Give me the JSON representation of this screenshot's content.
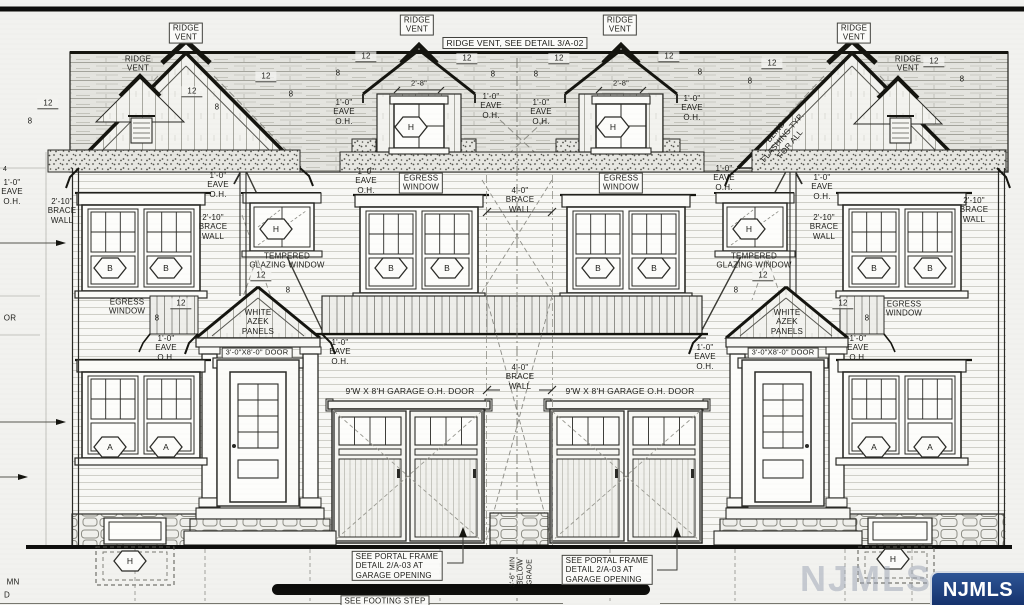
{
  "watermark": {
    "badge_text": "NJMLS",
    "ghost_text": "NJMLS",
    "badge_bg": "#14306a",
    "badge_fg": "#ffffff"
  },
  "labels": [
    {
      "name": "ridge-vent-label-1",
      "text": "RIDGE\nVENT",
      "x": 186,
      "y": 33,
      "boxed": true
    },
    {
      "name": "ridge-vent-label-2",
      "text": "RIDGE\nVENT",
      "x": 138,
      "y": 64
    },
    {
      "name": "ridge-vent-label-3",
      "text": "RIDGE\nVENT",
      "x": 417,
      "y": 25,
      "boxed": true
    },
    {
      "name": "ridge-vent-detail-note",
      "text": "RIDGE VENT, SEE DETAIL 3/A-02",
      "x": 515,
      "y": 43,
      "boxed": true,
      "size": 8.5
    },
    {
      "name": "ridge-vent-label-4",
      "text": "RIDGE\nVENT",
      "x": 620,
      "y": 25,
      "boxed": true
    },
    {
      "name": "ridge-vent-label-5",
      "text": "RIDGE\nVENT",
      "x": 854,
      "y": 33,
      "boxed": true
    },
    {
      "name": "ridge-vent-label-6",
      "text": "RIDGE\nVENT",
      "x": 908,
      "y": 64
    },
    {
      "name": "blind-flashing-note",
      "text": "BLIND\nFLASHING TYP.\nFOR ALL",
      "x": 783,
      "y": 138,
      "rot": -50
    },
    {
      "name": "eave-oh-label-1",
      "text": "1'-0\"\nEAVE\nO.H.",
      "x": 12,
      "y": 192
    },
    {
      "name": "eave-oh-label-2",
      "text": "1'-0\"\nEAVE\nO.H.",
      "x": 218,
      "y": 185
    },
    {
      "name": "eave-oh-label-3",
      "text": "1'-0\"\nEAVE\nO.H.",
      "x": 344,
      "y": 112
    },
    {
      "name": "eave-oh-label-4",
      "text": "1'-0\"\nEAVE\nO.H.",
      "x": 491,
      "y": 106
    },
    {
      "name": "eave-oh-label-5",
      "text": "1'-0\"\nEAVE\nO.H.",
      "x": 541,
      "y": 112
    },
    {
      "name": "eave-oh-label-6",
      "text": "1'-0\"\nEAVE\nO.H.",
      "x": 692,
      "y": 108
    },
    {
      "name": "eave-oh-label-7",
      "text": "1'-0\"\nEAVE\nO.H.",
      "x": 822,
      "y": 187
    },
    {
      "name": "eave-oh-label-8",
      "text": "1'-0\"\nEAVE\nO.H.",
      "x": 366,
      "y": 181
    },
    {
      "name": "eave-oh-label-9",
      "text": "1'-0\"\nEAVE\nO.H.",
      "x": 724,
      "y": 178
    },
    {
      "name": "eave-oh-label-10",
      "text": "1'-0\"\nEAVE\nO.H.",
      "x": 340,
      "y": 352
    },
    {
      "name": "eave-oh-label-11",
      "text": "1'-0\"\nEAVE\nO.H.",
      "x": 705,
      "y": 357
    },
    {
      "name": "eave-oh-label-12",
      "text": "1'-0\"\nEAVE\nO.H.",
      "x": 166,
      "y": 348
    },
    {
      "name": "eave-oh-label-13",
      "text": "1'-0\"\nEAVE\nO.H.",
      "x": 858,
      "y": 348
    },
    {
      "name": "brace-wall-label-left",
      "text": "2'-10\"\nBRACE\nWALL",
      "x": 62,
      "y": 211
    },
    {
      "name": "brace-wall-label-left-inner",
      "text": "2'-10\"\nBRACE\nWALL",
      "x": 213,
      "y": 227
    },
    {
      "name": "brace-wall-label-right-inner",
      "text": "2'-10\"\nBRACE\nWALL",
      "x": 824,
      "y": 227
    },
    {
      "name": "brace-wall-label-right",
      "text": "2'-10\"\nBRACE\nWALL",
      "x": 974,
      "y": 210
    },
    {
      "name": "brace-wall-label-center-upper",
      "text": "4'-0\"\nBRACE\nWALL",
      "x": 520,
      "y": 200
    },
    {
      "name": "brace-wall-label-center-lower",
      "text": "4'-0\"\nBRACE\nWALL",
      "x": 520,
      "y": 377
    },
    {
      "name": "egress-window-label-left",
      "text": "EGRESS\nWINDOW",
      "x": 127,
      "y": 307
    },
    {
      "name": "egress-window-label-center-left",
      "text": "EGRESS\nWINDOW",
      "x": 421,
      "y": 183,
      "boxed": true
    },
    {
      "name": "egress-window-label-center-right",
      "text": "EGRESS\nWINDOW",
      "x": 621,
      "y": 183,
      "boxed": true
    },
    {
      "name": "egress-window-label-right",
      "text": "EGRESS\nWINDOW",
      "x": 904,
      "y": 309
    },
    {
      "name": "tempered-glazing-label-left",
      "text": "TEMPERED\nGLAZING WINDOW",
      "x": 287,
      "y": 261
    },
    {
      "name": "tempered-glazing-label-right",
      "text": "TEMPERED\nGLAZING WINDOW",
      "x": 754,
      "y": 261
    },
    {
      "name": "azek-panels-label-left",
      "text": "WHITE\nAZEK\nPANELS",
      "x": 258,
      "y": 322
    },
    {
      "name": "azek-panels-label-right",
      "text": "WHITE\nAZEK\nPANELS",
      "x": 787,
      "y": 322
    },
    {
      "name": "entry-door-label-left",
      "text": "3'-0\"X8'-0\" DOOR",
      "x": 257,
      "y": 353,
      "boxed": true,
      "size": 7.5
    },
    {
      "name": "entry-door-label-right",
      "text": "3'-0\"X8'-0\" DOOR",
      "x": 783,
      "y": 353,
      "boxed": true,
      "size": 7.5
    },
    {
      "name": "garage-door-label-left",
      "text": "9'W X 8'H GARAGE O.H. DOOR",
      "x": 410,
      "y": 391,
      "size": 8.5
    },
    {
      "name": "garage-door-label-right",
      "text": "9'W X 8'H GARAGE O.H. DOOR",
      "x": 630,
      "y": 391,
      "size": 8.5
    },
    {
      "name": "portal-frame-note-left",
      "text": "SEE PORTAL FRAME\nDETAIL 2/A-03 AT\nGARAGE OPENING",
      "x": 397,
      "y": 566,
      "boxed": true,
      "align": "left"
    },
    {
      "name": "portal-frame-note-right",
      "text": "SEE PORTAL FRAME\nDETAIL 2/A-03 AT\nGARAGE OPENING",
      "x": 607,
      "y": 570,
      "boxed": true,
      "align": "left"
    },
    {
      "name": "footing-step-note",
      "text": "SEE FOOTING STEP",
      "x": 385,
      "y": 601,
      "boxed": true
    },
    {
      "name": "below-grade-note",
      "text": "3'-6\" MIN\nBELOW\nGRADE",
      "x": 522,
      "y": 572,
      "rot": -90,
      "size": 7
    },
    {
      "name": "dormer-width-dim-left",
      "text": "2'-8\"",
      "x": 419,
      "y": 84,
      "size": 7.5
    },
    {
      "name": "dormer-width-dim-right",
      "text": "2'-8\"",
      "x": 621,
      "y": 84,
      "size": 7.5
    },
    {
      "name": "partial-text-door",
      "text": "OR",
      "x": 10,
      "y": 318
    },
    {
      "name": "partial-text-column",
      "text": "MN",
      "x": 13,
      "y": 582
    },
    {
      "name": "partial-text-beyond",
      "text": "D",
      "x": 7,
      "y": 595
    },
    {
      "name": "partial-text-4",
      "text": "4",
      "x": 5,
      "y": 170,
      "size": 7
    },
    {
      "name": "slope-12-1",
      "text": "12",
      "x": 48,
      "y": 104,
      "cls": "dim"
    },
    {
      "name": "slope-12-2",
      "text": "12",
      "x": 192,
      "y": 92,
      "cls": "dim"
    },
    {
      "name": "slope-12-3",
      "text": "12",
      "x": 266,
      "y": 77,
      "cls": "dim"
    },
    {
      "name": "slope-12-4",
      "text": "12",
      "x": 366,
      "y": 57,
      "cls": "dim"
    },
    {
      "name": "slope-12-5",
      "text": "12",
      "x": 467,
      "y": 59,
      "cls": "dim"
    },
    {
      "name": "slope-12-6",
      "text": "12",
      "x": 559,
      "y": 59,
      "cls": "dim"
    },
    {
      "name": "slope-12-7",
      "text": "12",
      "x": 669,
      "y": 57,
      "cls": "dim"
    },
    {
      "name": "slope-12-8",
      "text": "12",
      "x": 772,
      "y": 64,
      "cls": "dim"
    },
    {
      "name": "slope-12-9",
      "text": "12",
      "x": 934,
      "y": 62,
      "cls": "dim"
    },
    {
      "name": "slope-12-10",
      "text": "12",
      "x": 261,
      "y": 276,
      "cls": "dim"
    },
    {
      "name": "slope-12-11",
      "text": "12",
      "x": 763,
      "y": 276,
      "cls": "dim"
    },
    {
      "name": "slope-12-12",
      "text": "12",
      "x": 181,
      "y": 304,
      "cls": "dim"
    },
    {
      "name": "slope-12-13",
      "text": "12",
      "x": 843,
      "y": 304,
      "cls": "dim"
    },
    {
      "name": "slope-8-1",
      "text": "8",
      "x": 30,
      "y": 121
    },
    {
      "name": "slope-8-2",
      "text": "8",
      "x": 217,
      "y": 107
    },
    {
      "name": "slope-8-3",
      "text": "8",
      "x": 291,
      "y": 94
    },
    {
      "name": "slope-8-4",
      "text": "8",
      "x": 338,
      "y": 73
    },
    {
      "name": "slope-8-5",
      "text": "8",
      "x": 493,
      "y": 74
    },
    {
      "name": "slope-8-6",
      "text": "8",
      "x": 536,
      "y": 74
    },
    {
      "name": "slope-8-7",
      "text": "8",
      "x": 700,
      "y": 72
    },
    {
      "name": "slope-8-8",
      "text": "8",
      "x": 750,
      "y": 81
    },
    {
      "name": "slope-8-9",
      "text": "8",
      "x": 962,
      "y": 79
    },
    {
      "name": "slope-8-10",
      "text": "8",
      "x": 288,
      "y": 290
    },
    {
      "name": "slope-8-11",
      "text": "8",
      "x": 736,
      "y": 290
    },
    {
      "name": "slope-8-12",
      "text": "8",
      "x": 157,
      "y": 318
    },
    {
      "name": "slope-8-13",
      "text": "8",
      "x": 867,
      "y": 318
    }
  ],
  "hexagons": [
    {
      "letter": "B",
      "x": 110,
      "y": 268
    },
    {
      "letter": "B",
      "x": 166,
      "y": 268
    },
    {
      "letter": "B",
      "x": 391,
      "y": 268
    },
    {
      "letter": "B",
      "x": 447,
      "y": 268
    },
    {
      "letter": "B",
      "x": 598,
      "y": 268
    },
    {
      "letter": "B",
      "x": 654,
      "y": 268
    },
    {
      "letter": "B",
      "x": 874,
      "y": 268
    },
    {
      "letter": "B",
      "x": 930,
      "y": 268
    },
    {
      "letter": "A",
      "x": 110,
      "y": 447
    },
    {
      "letter": "A",
      "x": 166,
      "y": 447
    },
    {
      "letter": "A",
      "x": 874,
      "y": 447
    },
    {
      "letter": "A",
      "x": 930,
      "y": 447
    },
    {
      "letter": "H",
      "x": 411,
      "y": 127
    },
    {
      "letter": "H",
      "x": 613,
      "y": 127
    },
    {
      "letter": "H",
      "x": 276,
      "y": 229
    },
    {
      "letter": "H",
      "x": 749,
      "y": 229
    },
    {
      "letter": "H",
      "x": 130,
      "y": 561
    },
    {
      "letter": "H",
      "x": 893,
      "y": 559
    }
  ]
}
